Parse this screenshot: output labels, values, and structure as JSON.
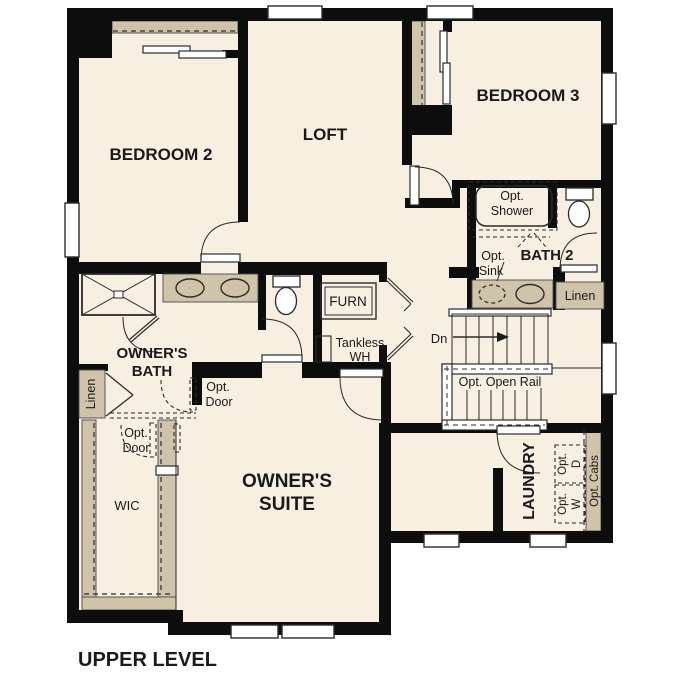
{
  "title": "UPPER LEVEL",
  "rooms": {
    "bedroom2": "BEDROOM 2",
    "loft": "LOFT",
    "bedroom3": "BEDROOM 3",
    "bath2": "BATH 2",
    "owners_bath_line1": "OWNER'S",
    "owners_bath_line2": "BATH",
    "owners_suite_line1": "OWNER'S",
    "owners_suite_line2": "SUITE",
    "wic": "WIC",
    "laundry": "LAUNDRY"
  },
  "labels": {
    "opt_shower_line1": "Opt.",
    "opt_shower_line2": "Shower",
    "opt_sink_line1": "Opt.",
    "opt_sink_line2": "Sink",
    "linen_bath2": "Linen",
    "linen_owners": "Linen",
    "furnace": "FURN",
    "tankless_line1": "Tankless",
    "tankless_line2": "WH",
    "stairs_down": "Dn",
    "opt_open_rail": "Opt. Open Rail",
    "opt_door_hall_line1": "Opt.",
    "opt_door_hall_line2": "Door",
    "opt_door_wic_line1": "Opt.",
    "opt_door_wic_line2": "Door",
    "opt_dryer_line1": "Opt.",
    "opt_dryer_line2": "D",
    "opt_washer_line1": "Opt.",
    "opt_washer_line2": "W",
    "opt_cabs": "Opt. Cabs"
  },
  "colors": {
    "floor": "#f7efe2",
    "wall": "#0d0d0d",
    "cabinet": "#cfc3aa",
    "fixture_blue": "#aacbea",
    "appliance": "#dcdfdc",
    "line": "#2b2b2b"
  }
}
